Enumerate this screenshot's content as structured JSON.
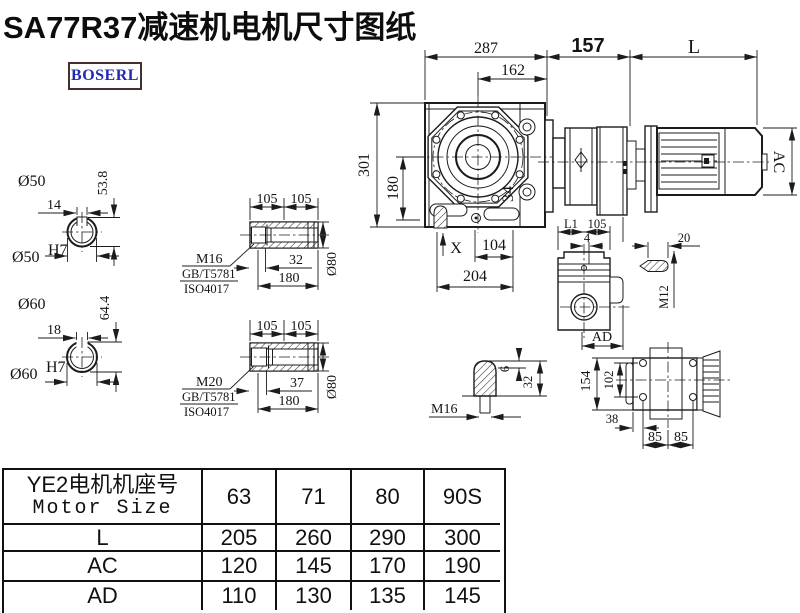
{
  "title": "SA77R37减速机电机尺寸图纸",
  "logo": "BOSERL",
  "main_view": {
    "dim_287": "287",
    "dim_162": "162",
    "dim_157": "157",
    "dim_L": "L",
    "dim_301": "301",
    "dim_180": "180",
    "dim_AC": "AC",
    "dim_34": "34",
    "dim_X": "X",
    "dim_104": "104",
    "dim_204": "204"
  },
  "shaft_50": {
    "label": "Ø50",
    "keyway_width": "14",
    "keyway_height": "53.8",
    "bore": "Ø50",
    "bore_tol": "H7"
  },
  "shaft_60": {
    "label": "Ø60",
    "keyway_width": "18",
    "keyway_height": "64.4",
    "bore": "Ø60",
    "bore_tol": "H7"
  },
  "bushing_m16": {
    "dim_105_left": "105",
    "dim_105_right": "105",
    "bolt": "M16",
    "std_gb": "GB/T5781",
    "std_iso": "ISO4017",
    "dim_32": "32",
    "dim_180": "180",
    "dim_dia": "Ø80"
  },
  "bushing_m20": {
    "dim_105_left": "105",
    "dim_105_right": "105",
    "bolt": "M20",
    "std_gb": "GB/T5781",
    "std_iso": "ISO4017",
    "dim_37": "37",
    "dim_180": "180",
    "dim_dia": "Ø80"
  },
  "side_view": {
    "dim_L1": "L1",
    "dim_105": "105",
    "dim_4": "4",
    "dim_AD": "AD"
  },
  "key_detail": {
    "dim_20": "20",
    "thread": "M12"
  },
  "shaft_end": {
    "dim_6": "6",
    "dim_32": "32",
    "thread": "M16"
  },
  "bottom_view": {
    "dim_154": "154",
    "dim_102": "102",
    "dim_38": "38",
    "dim_85_left": "85",
    "dim_85_right": "85"
  },
  "table": {
    "header_line1": "YE2电机机座号",
    "header_line2": "Motor Size",
    "frame_sizes": [
      "63",
      "71",
      "80",
      "90S"
    ],
    "rows": [
      {
        "label": "L",
        "values": [
          "205",
          "260",
          "290",
          "300"
        ]
      },
      {
        "label": "AC",
        "values": [
          "120",
          "145",
          "170",
          "190"
        ]
      },
      {
        "label": "AD",
        "values": [
          "110",
          "130",
          "135",
          "145"
        ]
      }
    ]
  }
}
